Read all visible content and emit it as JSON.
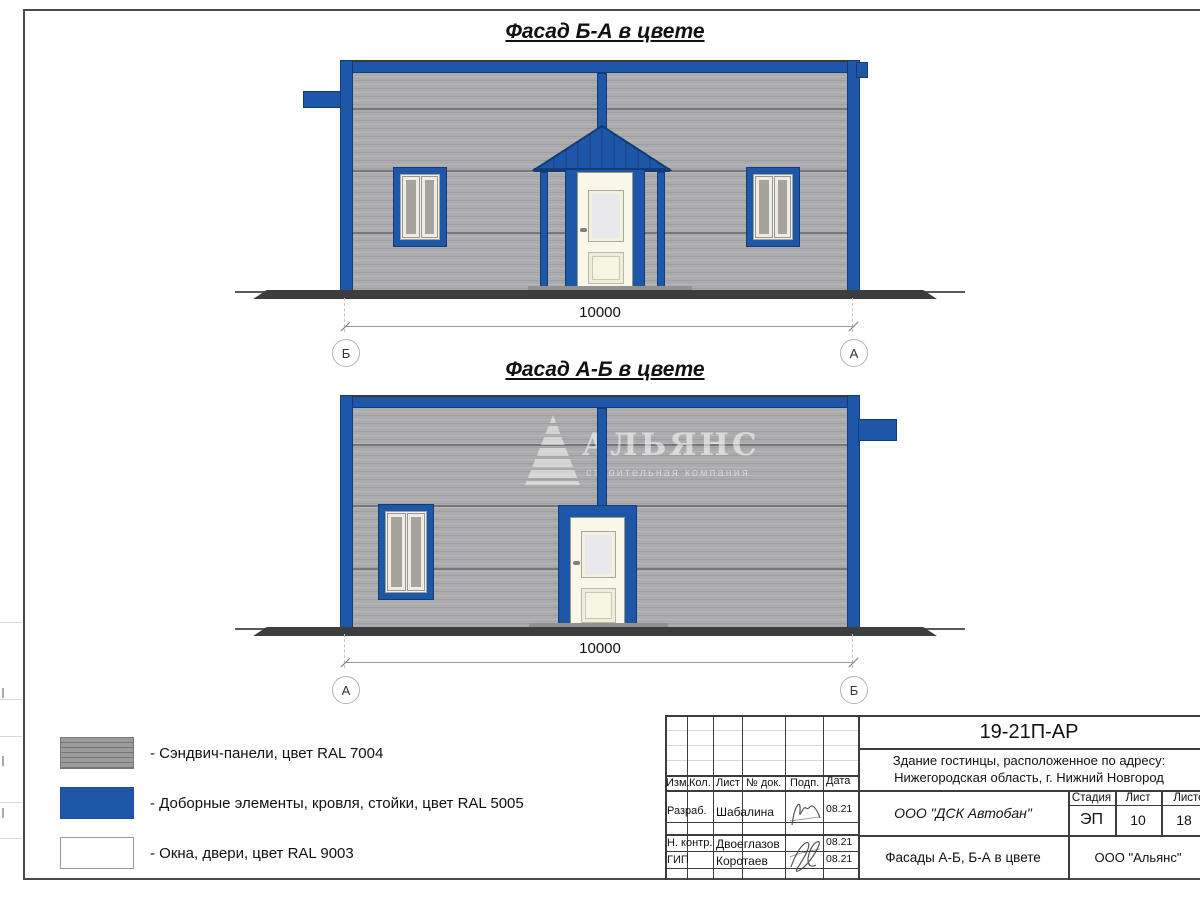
{
  "facade_top": {
    "title": "Фасад Б-А в цвете",
    "dimension": "10000",
    "axis_left": "Б",
    "axis_right": "А"
  },
  "facade_bottom": {
    "title": "Фасад А-Б в цвете",
    "dimension": "10000",
    "axis_left": "А",
    "axis_right": "Б"
  },
  "watermark": {
    "name": "АЛЬЯНС",
    "tagline": "строительная компания"
  },
  "legend": {
    "items": [
      {
        "label": "- Сэндвич-панели, цвет RAL 7004",
        "color": "#9c9c9c"
      },
      {
        "label": "- Доборные элементы, кровля, стойки, цвет RAL 5005",
        "color": "#1e57a8"
      },
      {
        "label": "- Окна, двери, цвет RAL 9003",
        "color": "#ffffff"
      }
    ]
  },
  "title_block": {
    "doc_number": "19-21П-АР",
    "project_line1": "Здание гостинцы, расположенное по адресу:",
    "project_line2": "Нижегородская область, г. Нижний Новгород",
    "columns": [
      "Изм.",
      "Кол.",
      "Лист",
      "№ док.",
      "Подп.",
      "Дата"
    ],
    "signers": [
      {
        "role": "Разраб.",
        "name": "Шабалина",
        "date": "08.21"
      },
      {
        "role": "Н. контр.",
        "name": "Двоеглазов",
        "date": "08.21"
      },
      {
        "role": "ГИП",
        "name": "Коротаев",
        "date": "08.21"
      }
    ],
    "contractor": "ООО \"ДСК Автобан\"",
    "stage_label": "Стадия",
    "stage": "ЭП",
    "sheet_label": "Лист",
    "sheet": "10",
    "sheets_label": "Листов",
    "sheets": "18",
    "sheet_title": "Фасады А-Б, Б-А в цвете",
    "organization": "ООО \"Альянс\""
  },
  "colors": {
    "ral5005_blue": "#1e57a8",
    "ral7004_gray": "#ababad",
    "ral9003_white": "#ffffff",
    "ground": "#3d3d3f"
  }
}
